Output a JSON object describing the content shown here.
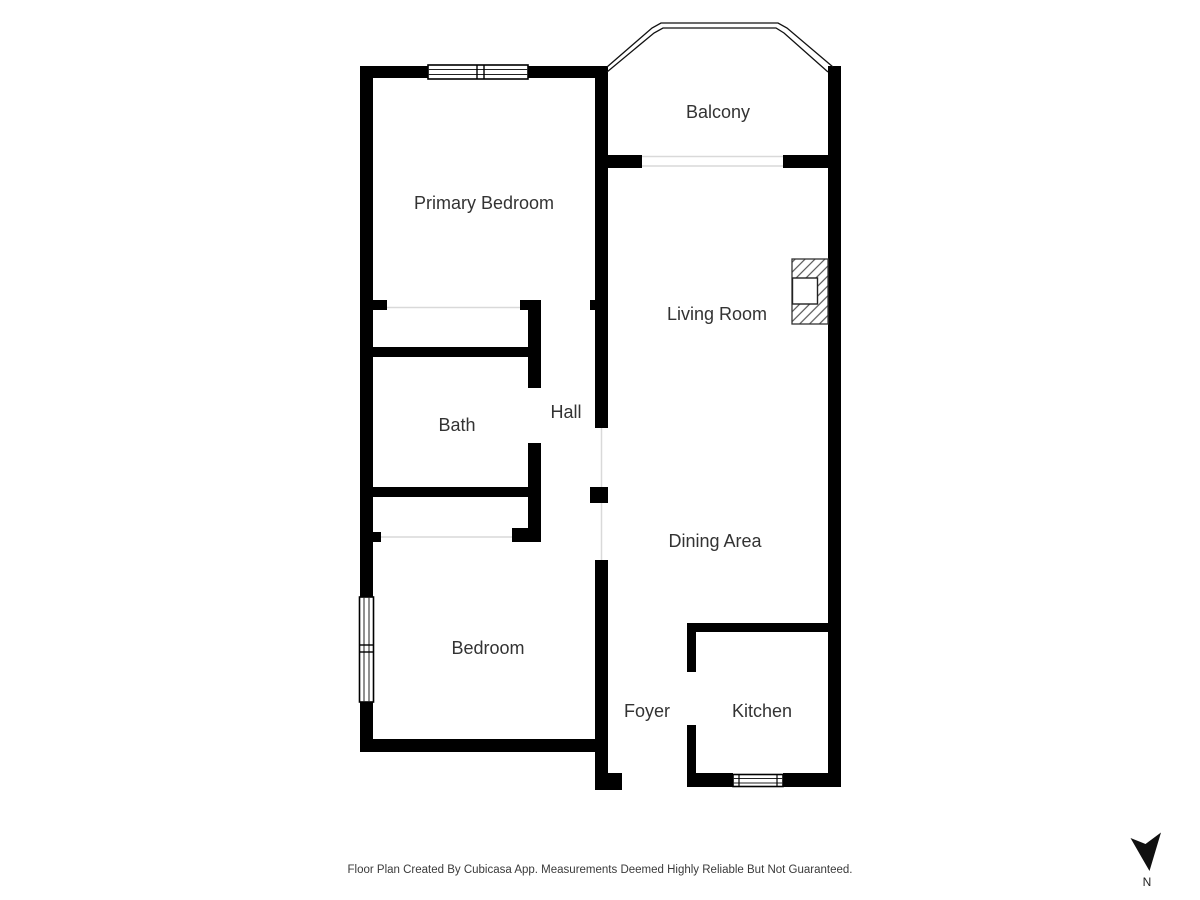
{
  "rooms": {
    "balcony": "Balcony",
    "primary_bedroom": "Primary Bedroom",
    "living_room": "Living Room",
    "bath": "Bath",
    "hall": "Hall",
    "dining_area": "Dining Area",
    "bedroom": "Bedroom",
    "foyer": "Foyer",
    "kitchen": "Kitchen"
  },
  "footer": {
    "disclaimer": "Floor Plan Created By Cubicasa App. Measurements Deemed Highly Reliable But Not Guaranteed."
  },
  "compass": {
    "north_label": "N"
  },
  "colors": {
    "wall": "#000000",
    "room_label": "#333333",
    "footer_text": "#3a3a3a",
    "background": "#ffffff",
    "opening_line": "#d9d9d9",
    "fireplace_hatch": "#555555"
  }
}
